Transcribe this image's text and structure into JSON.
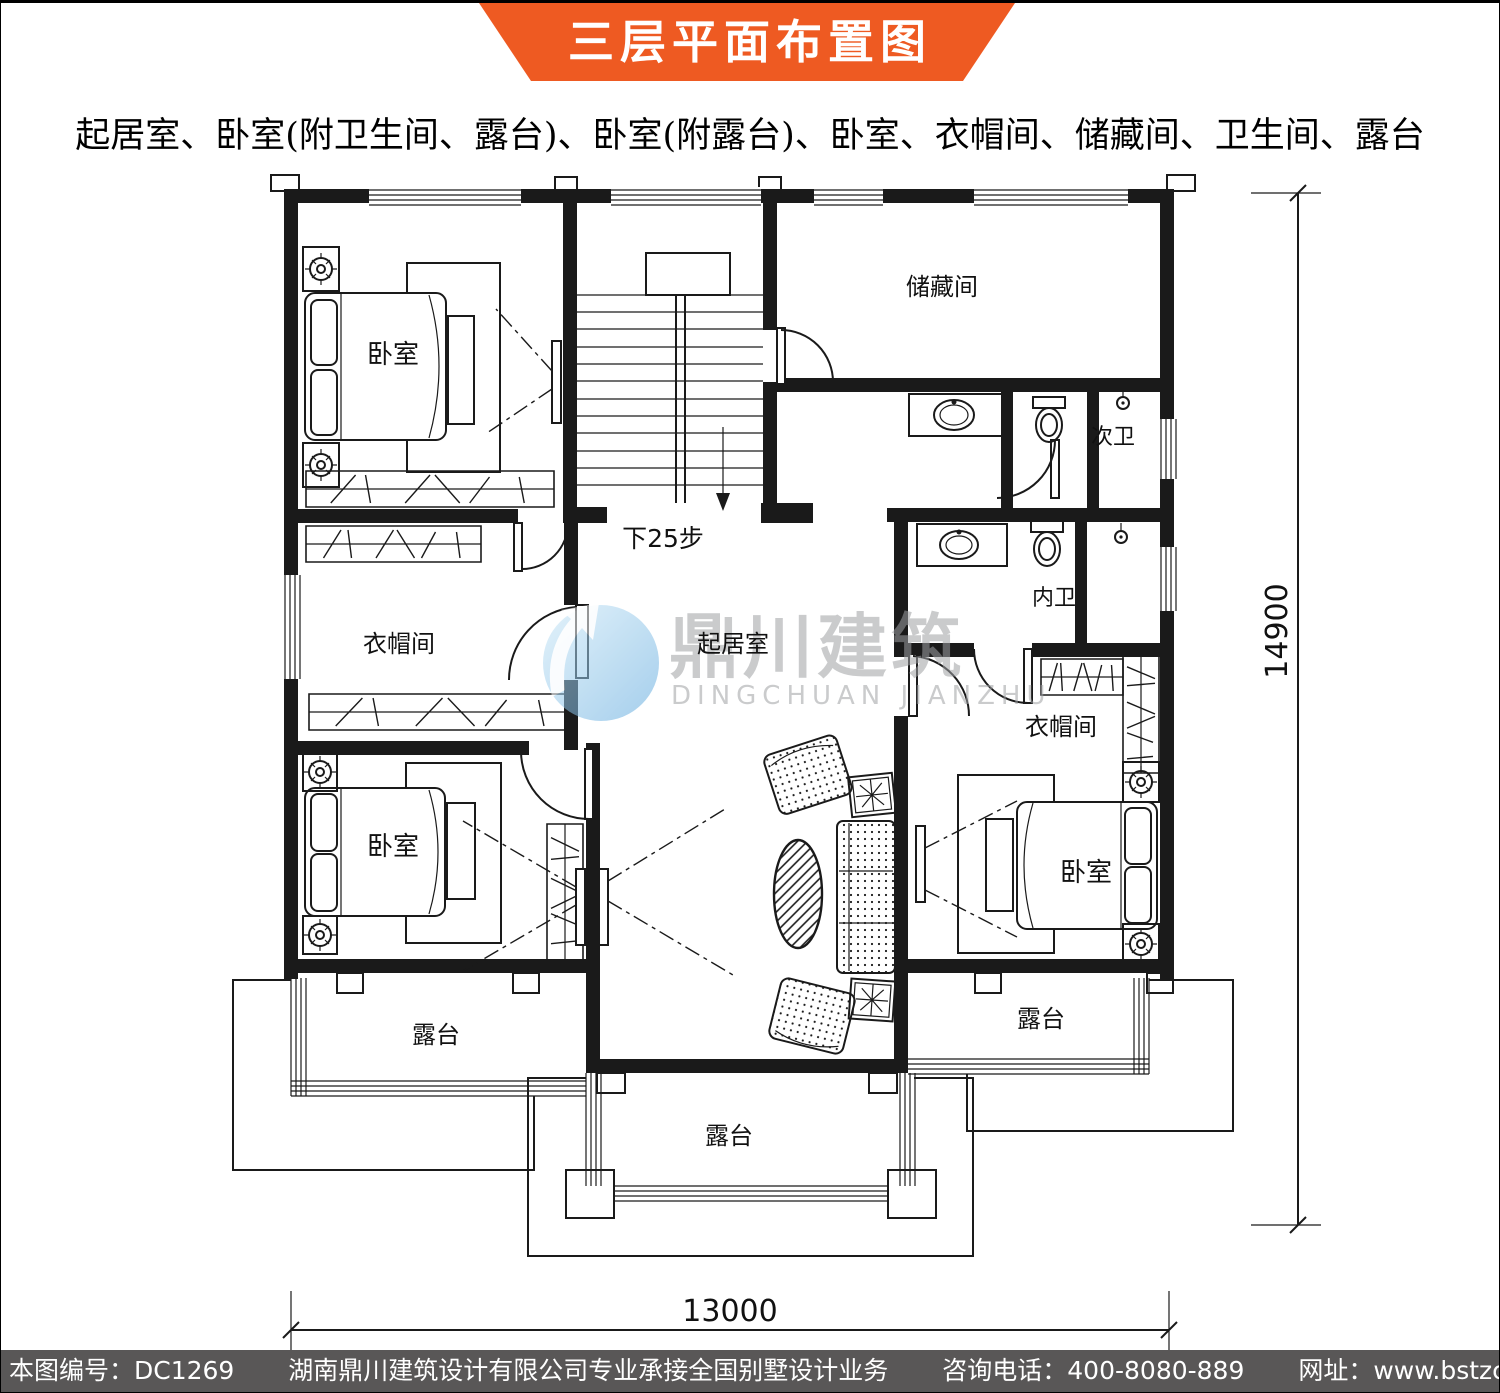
{
  "banner": {
    "title": "三层平面布置图",
    "bg_color": "#ee5a22",
    "text_color": "#ffffff"
  },
  "subtitle": "起居室、卧室(附卫生间、露台)、卧室(附露台)、卧室、衣帽间、储藏间、卫生间、露台",
  "plan": {
    "rooms": {
      "bedroom_tl": "卧室",
      "bedroom_bl": "卧室",
      "bedroom_br": "卧室",
      "storage": "储藏间",
      "bath_secondary": "次卫",
      "bath_master": "内卫",
      "cloak_left": "衣帽间",
      "cloak_right": "衣帽间",
      "living": "起居室",
      "terrace_left": "露台",
      "terrace_right": "露台",
      "terrace_center": "露台",
      "stairs_note": "下25步"
    },
    "dimensions": {
      "width": "13000",
      "height": "14900"
    },
    "line_color": "#1a1a1a"
  },
  "watermark": {
    "cn": "鼎川建筑",
    "en": "DINGCHUAN JIANZHU",
    "gray": "#9fa1a4",
    "logo_blue": "#5ba7dd"
  },
  "footer": {
    "bg_color": "#595757",
    "drawing_no": "本图编号：DC1269",
    "company": "湖南鼎川建筑设计有限公司专业承接全国别墅设计业务",
    "phone": "咨询电话：400-8080-889",
    "website": "网址：www.bstzcs.com"
  }
}
